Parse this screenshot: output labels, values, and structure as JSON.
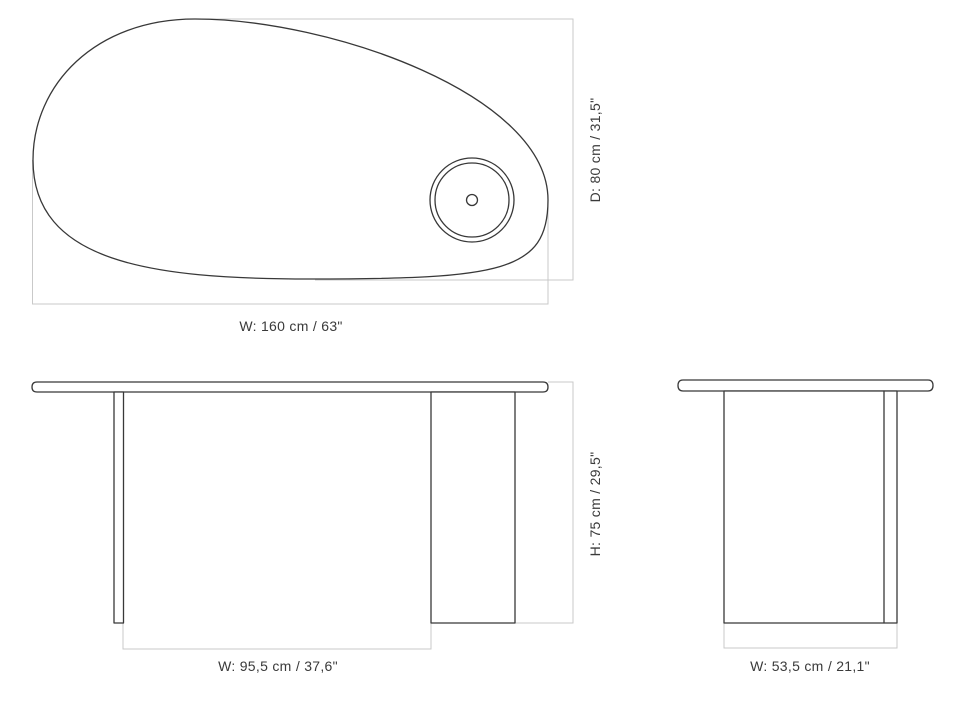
{
  "drawing": {
    "type": "furniture-dimension-diagram",
    "background_color": "#ffffff",
    "outline_color": "#383838",
    "extension_line_color": "#c9c9c9",
    "label_color": "#3a3a3a",
    "top_view": {
      "width_label": "W: 160 cm / 63\"",
      "depth_label": "D: 80 cm / 31,5\""
    },
    "front_view": {
      "width_label": "W: 95,5 cm / 37,6\"",
      "height_label": "H: 75 cm / 29,5\""
    },
    "side_view": {
      "width_label": "W: 53,5 cm / 21,1\""
    }
  }
}
